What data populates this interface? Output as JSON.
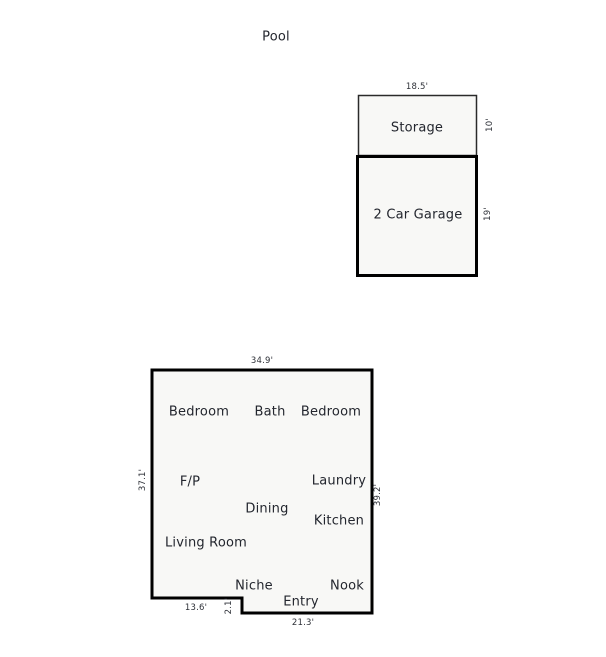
{
  "colors": {
    "room_fill": "#f8f8f6",
    "outline": "#000000",
    "storage_outline": "#2a2a2a",
    "text": "#23262e"
  },
  "pool": {
    "label": "Pool"
  },
  "outbuilding": {
    "storage": {
      "label": "Storage",
      "width_dim": "18.5'",
      "height_dim": "10'"
    },
    "garage": {
      "label": "2 Car Garage",
      "height_dim": "19'"
    }
  },
  "house": {
    "rooms": [
      {
        "label": "Bedroom"
      },
      {
        "label": "Bath"
      },
      {
        "label": "Bedroom"
      },
      {
        "label": "F/P"
      },
      {
        "label": "Laundry"
      },
      {
        "label": "Dining"
      },
      {
        "label": "Kitchen"
      },
      {
        "label": "Living Room"
      },
      {
        "label": "Niche"
      },
      {
        "label": "Nook"
      },
      {
        "label": "Entry"
      }
    ],
    "dimensions": {
      "top": "34.9'",
      "left": "37.1'",
      "right": "39.2'",
      "bottom_left": "13.6'",
      "step": "2.1'",
      "bottom_right": "21.3'"
    }
  }
}
